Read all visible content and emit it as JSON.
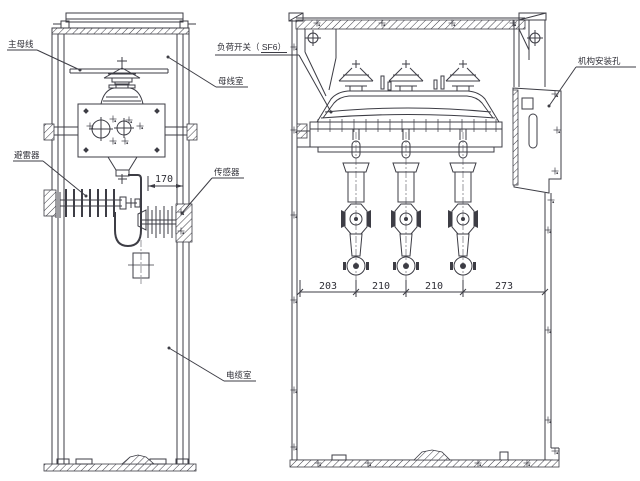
{
  "drawing": {
    "type": "engineering-drawing",
    "subject": "SF6 load-break switchgear cabinet, sectional views",
    "annotations": {
      "main_busbar": "主母线",
      "load_switch": "负荷开关（ SF6）",
      "busbar_compartment": "母线室",
      "surge_arrester": "避雷器",
      "sensor": "传感器",
      "cable_compartment": "电缆室",
      "mechanism_mounting_hole": "机构安装孔"
    },
    "dimensions": {
      "arrester_offset": "170",
      "phase_spacings": [
        "203",
        "210",
        "210",
        "273"
      ]
    },
    "colors": {
      "line": "#3d3d45",
      "background": "#ffffff"
    }
  }
}
